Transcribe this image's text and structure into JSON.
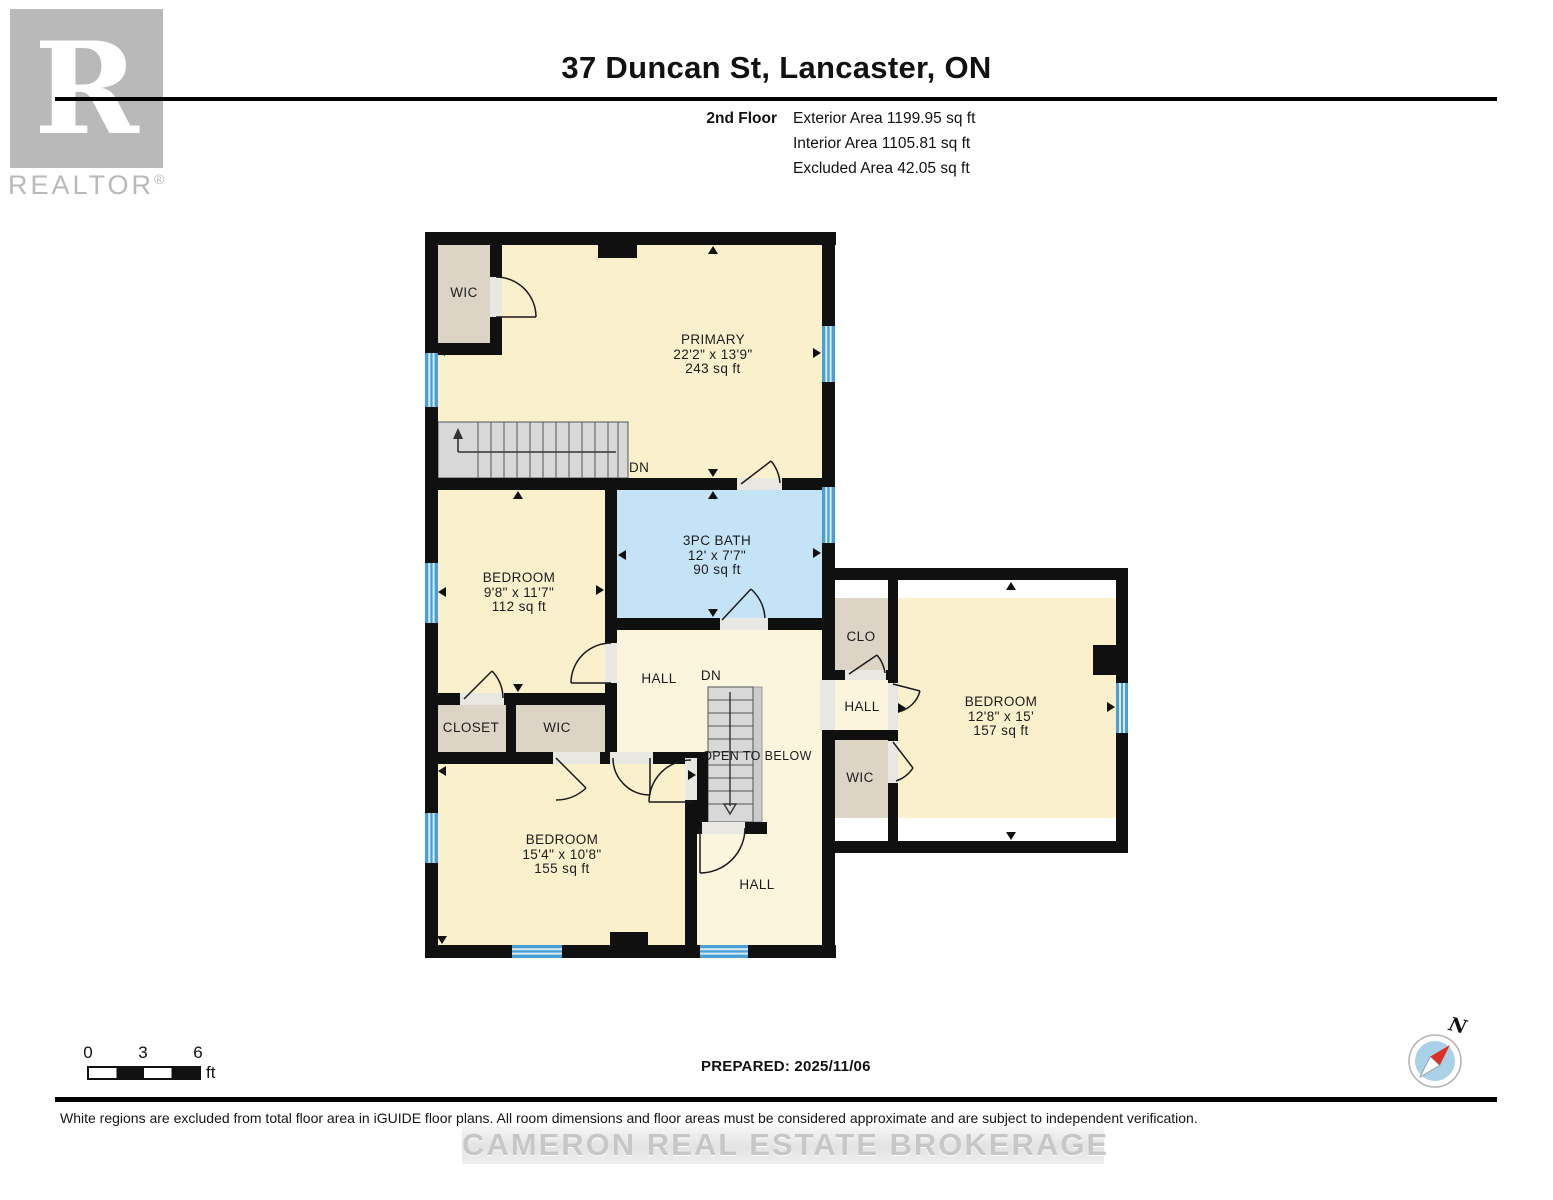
{
  "branding": {
    "logo_letter": "R",
    "logo_text": "REALTOR",
    "logo_reg": "®",
    "watermark": "CAMERON REAL ESTATE BROKERAGE"
  },
  "header": {
    "title": "37 Duncan St, Lancaster, ON",
    "floor_label": "2nd Floor",
    "exterior": "Exterior Area 1199.95 sq ft",
    "interior": "Interior Area 1105.81 sq ft",
    "excluded": "Excluded Area 42.05 sq ft"
  },
  "rooms": {
    "wic_top_left": {
      "name": "WIC"
    },
    "primary": {
      "name": "PRIMARY",
      "dims": "22'2\" x 13'9\"",
      "area": "243 sq ft"
    },
    "bedroom_left": {
      "name": "BEDROOM",
      "dims": "9'8\" x 11'7\"",
      "area": "112 sq ft"
    },
    "bath": {
      "name": "3PC BATH",
      "dims": "12' x 7'7\"",
      "area": "90 sq ft"
    },
    "hall_center": {
      "name": "HALL"
    },
    "closet": {
      "name": "CLOSET"
    },
    "wic_center": {
      "name": "WIC"
    },
    "bedroom_bottom": {
      "name": "BEDROOM",
      "dims": "15'4\" x 10'8\"",
      "area": "155 sq ft"
    },
    "hall_bottom": {
      "name": "HALL"
    },
    "closet_right": {
      "name": "CLO"
    },
    "hall_right": {
      "name": "HALL"
    },
    "wic_right": {
      "name": "WIC"
    },
    "bedroom_right": {
      "name": "BEDROOM",
      "dims": "12'8\" x 15'",
      "area": "157 sq ft"
    }
  },
  "annotations": {
    "dn_upper": "DN",
    "dn_lower": "DN",
    "open_to_below": "OPEN TO BELOW"
  },
  "scale_bar": {
    "t0": "0",
    "t3": "3",
    "t6": "6",
    "unit": "ft"
  },
  "footer": {
    "prepared": "PREPARED: 2025/11/06",
    "disclaimer": "White regions are excluded from total floor area in iGUIDE floor plans. All room dimensions and floor areas must be considered approximate and are subject to independent verification.",
    "north": "N"
  },
  "colors": {
    "room_fill": "#FAF0CB",
    "closet_fill": "#DCD5C6",
    "bath_fill": "#C5E3F7",
    "hall_fill": "#FBF5DE",
    "wall": "#101010",
    "window": "#4C9FD3"
  }
}
